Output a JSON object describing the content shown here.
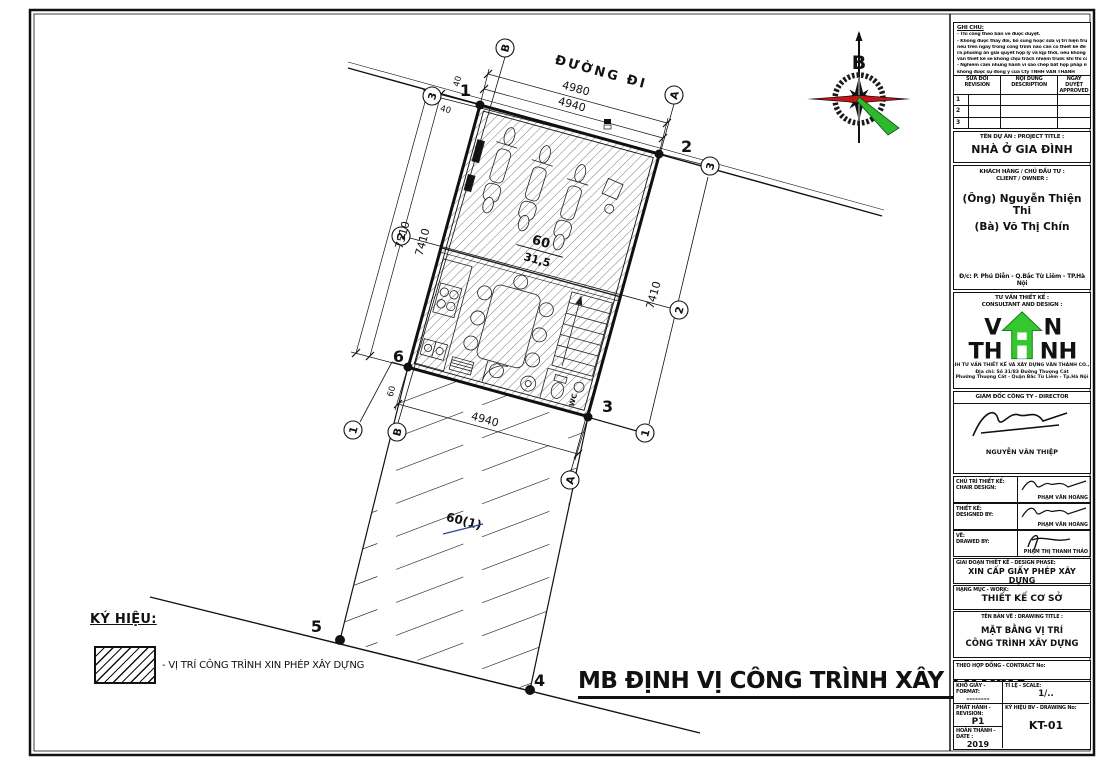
{
  "drawing": {
    "road_label": "ĐƯỜNG ĐI",
    "main_title": "MB ĐỊNH VỊ CÔNG TRÌNH XÂY DỰNG",
    "compass_north": "B",
    "legend": {
      "heading": "KÝ HIỆU:",
      "item": "- VỊ TRÍ CÔNG TRÌNH XIN PHÉP XÂY DỰNG"
    },
    "lot": {
      "number": "60",
      "area": "31,5",
      "adjacent_lot": "60(1)"
    },
    "axes": {
      "a": "A",
      "b": "B",
      "n1": "1",
      "n2": "2",
      "n3": "3"
    },
    "corners": {
      "c1": "1",
      "c2": "2",
      "c3": "3",
      "c4": "4",
      "c5": "5",
      "c6": "6"
    },
    "dims": {
      "top_outer": "4980",
      "top_inner": "4940",
      "bottom": "4940",
      "left_outer": "7510",
      "left_inner": "7410",
      "right": "7410",
      "offset_top": "40",
      "offset_left": "40",
      "offset_bottom": "60"
    },
    "labels": {
      "wc": "WC"
    },
    "colors": {
      "accent_blue": "#27489e",
      "accent_orange": "#c0621a",
      "logo_green": "#35c72f",
      "compass_red": "#c81414",
      "compass_green": "#2db82d"
    }
  },
  "titleblock": {
    "notes": {
      "heading": "GHI CHÚ:",
      "lines": [
        "- Thi công theo bản vẽ được duyệt.",
        "- Không được thay đổi, bổ sung hoặc sửa vị trí hiện trường",
        "nếu trên ngay trong công trình nào cần có thiết kế để đưa",
        "ra phương án giải quyết hợp lý và kịp thời, nếu không tư",
        "vấn thiết kế sẽ không chịu trách nhiệm trước khi thi công.",
        "- Nghiêm cấm những hành vi sao chép bất hợp pháp mà",
        "không được sự đồng ý của Cty TNHH VĂN THÀNH"
      ]
    },
    "revision_table": {
      "headers": [
        {
          "vi": "SỬA ĐỔI",
          "en": "REVISION"
        },
        {
          "vi": "NỘI DUNG",
          "en": "DESCRIPTION"
        },
        {
          "vi": "NGÀY DUYỆT",
          "en": "APPROVED"
        }
      ],
      "rows": [
        "1",
        "2",
        "3"
      ]
    },
    "project": {
      "label": "TÊN DỰ ÁN : PROJECT TITLE :",
      "value": "NHÀ Ở GIA ĐÌNH"
    },
    "client": {
      "label_vi": "KHÁCH HÀNG / CHỦ ĐẦU TƯ :",
      "label_en": "CLIENT / OWNER :",
      "line1": "(Ông) Nguyễn Thiện Thi",
      "line2": "(Bà) Võ Thị Chín",
      "address": "Đ/c: P. Phú Diễn - Q.Bắc Từ Liêm - TP.Hà Nội"
    },
    "consultant": {
      "label_vi": "TƯ VẤN THIẾT KẾ :",
      "label_en": "CONSULTANT AND DESIGN :",
      "logo": {
        "l1a": "V",
        "l1b": "N",
        "l2a": "TH",
        "l2b": "NH"
      },
      "company_line": "TNHH TƯ VẤN THIẾT KẾ VÀ XÂY DỰNG VĂN THÀNH CO.,LTD",
      "address1": "Địa chỉ: Số 31/83 Đường Thượng Cát",
      "address2": "Phường Thượng Cát - Quận Bắc Từ Liêm - Tp.Hà Nội"
    },
    "director": {
      "label": "GIÁM ĐỐC CÔNG TY - DIRECTOR",
      "name": "NGUYỄN VĂN THIỆP"
    },
    "sign_rows": [
      {
        "label_vi": "CHỦ TRÌ THIẾT KẾ:",
        "label_en": "CHAIR DESIGN:",
        "name": "PHẠM VĂN HOÀNG"
      },
      {
        "label_vi": "THIẾT KẾ:",
        "label_en": "DESIGNED BY:",
        "name": "PHẠM VĂN HOÀNG"
      },
      {
        "label_vi": "VẼ:",
        "label_en": "DRAWED BY:",
        "name": "PHẠM THỊ THANH THẢO"
      }
    ],
    "phase": {
      "label": "GIAI ĐOẠN THIẾT KẾ - DESIGN PHASE:",
      "value": "XIN CẤP GIẤY PHÉP XÂY DỰNG"
    },
    "work": {
      "label": "HẠNG MỤC - WORK:",
      "value": "THIẾT KẾ CƠ SỞ"
    },
    "drawing_title": {
      "label": "TÊN BẢN VẼ : DRAWING TITLE :",
      "line1": "MẶT BẰNG VỊ TRÍ",
      "line2": "CÔNG TRÌNH XÂY DỰNG"
    },
    "contract": {
      "label": "THEO HỢP ĐỒNG - CONTRACT No:"
    },
    "format": {
      "label": "KHỔ GIẤY - FORMAT:",
      "value": "--------"
    },
    "scale": {
      "label": "TỈ LỆ - SCALE:",
      "value": "1/.."
    },
    "revision": {
      "label": "PHÁT HÀNH - REVISION:",
      "value": "P1"
    },
    "drawing_no": {
      "label": "KÝ HIỆU BV - DRAWING No:",
      "value": "KT-01"
    },
    "date": {
      "label": "HOÀN THÀNH - DATE :",
      "value": "2019"
    }
  }
}
